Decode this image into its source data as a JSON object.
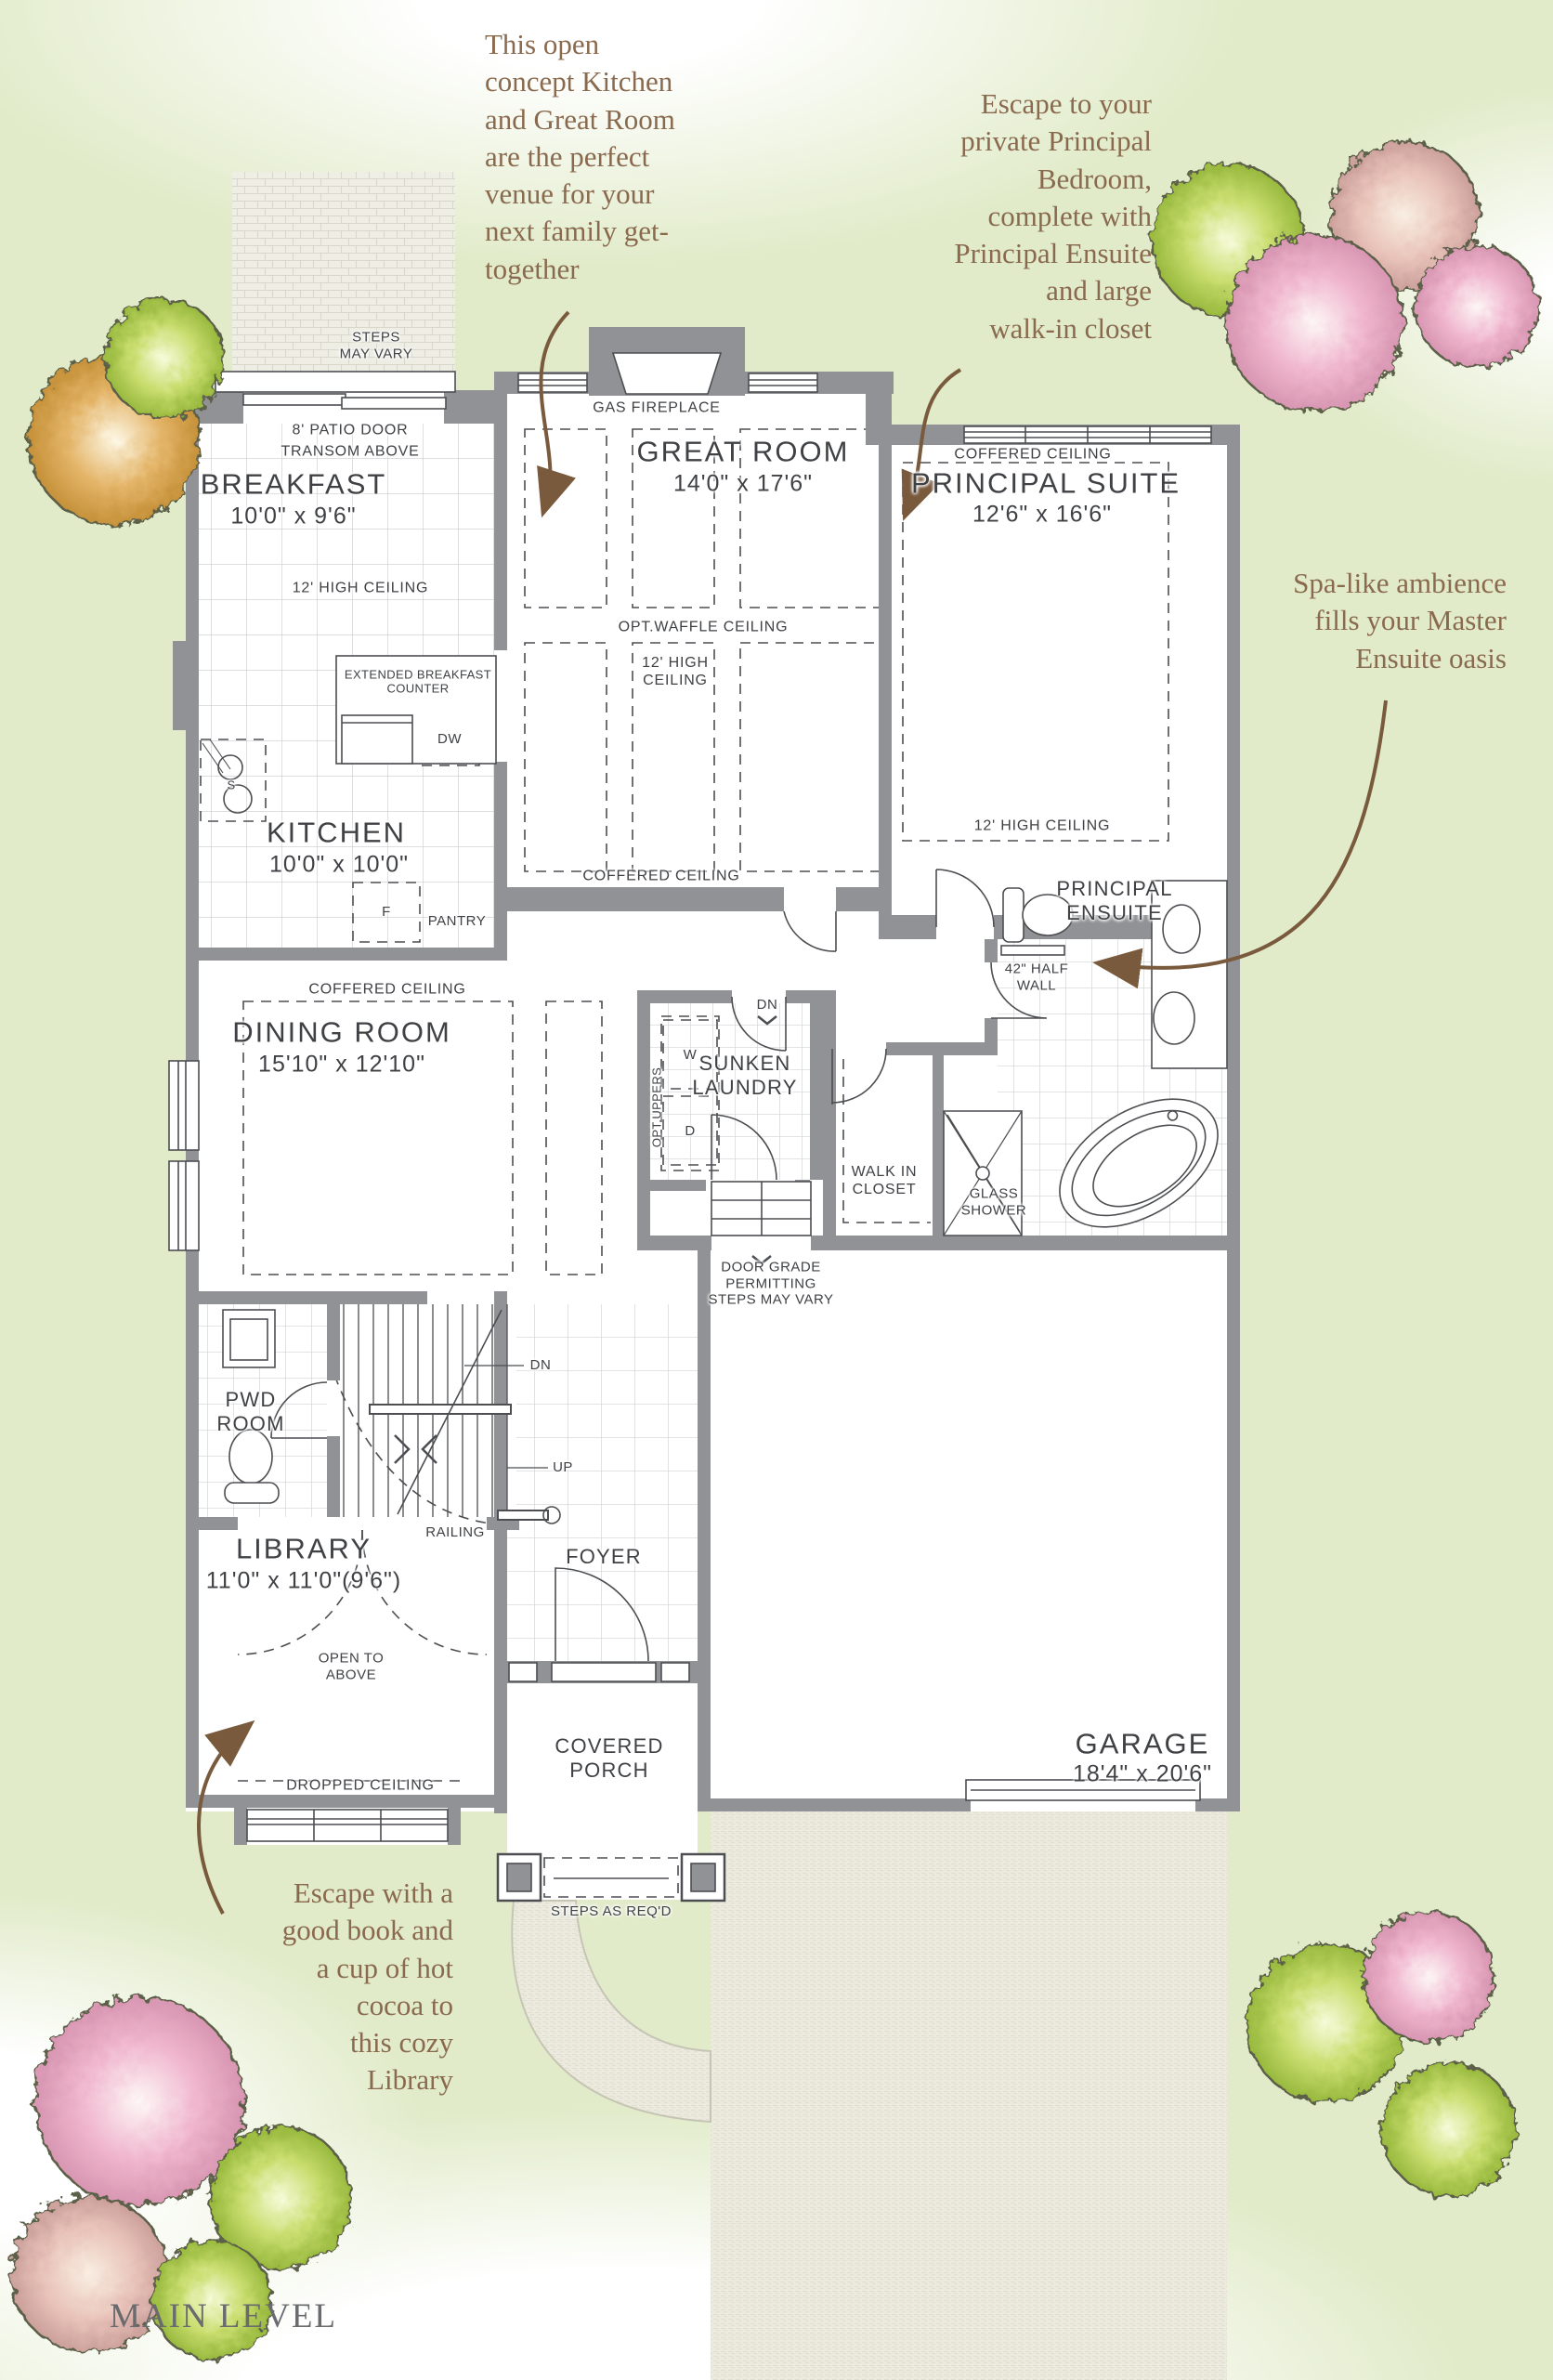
{
  "page": {
    "footer": "MAIN LEVEL"
  },
  "annotations": {
    "kitchen_note": "This open\nconcept Kitchen\nand Great Room\nare the perfect\nvenue for your\nnext family get-\ntogether",
    "principal_note": "Escape to your\nprivate Principal\nBedroom,\ncomplete with\nPrincipal Ensuite\nand large\nwalk-in closet",
    "ensuite_note": "Spa-like ambience\nfills your Master\nEnsuite oasis",
    "library_note": "Escape with a\ngood book and\na cup of hot\ncocoa to\nthis cozy\nLibrary"
  },
  "rooms": {
    "patio": {
      "steps": "STEPS\nMAY VARY",
      "door": "8' PATIO DOOR",
      "transom": "TRANSOM ABOVE"
    },
    "breakfast": {
      "name": "BREAKFAST",
      "dims": "10'0\" x 9'6\"",
      "ceiling": "12' HIGH CEILING"
    },
    "great_room": {
      "name": "GREAT ROOM",
      "dims": "14'0\" x 17'6\"",
      "fireplace": "GAS FIREPLACE",
      "waffle": "OPT.WAFFLE CEILING",
      "ceiling": "12' HIGH\nCEILING",
      "coffered": "COFFERED CEILING"
    },
    "principal_suite": {
      "name": "PRINCIPAL SUITE",
      "dims": "12'6\" x 16'6\"",
      "coffered": "COFFERED CEILING",
      "ceiling": "12' HIGH CEILING"
    },
    "kitchen": {
      "name": "KITCHEN",
      "dims": "10'0\" x 10'0\"",
      "counter": "EXTENDED BREAKFAST\nCOUNTER",
      "dishwasher": "DW",
      "sink": "S",
      "fridge": "F",
      "pantry": "PANTRY"
    },
    "dining": {
      "name": "DINING ROOM",
      "dims": "15'10\" x 12'10\"",
      "coffered": "COFFERED CEILING",
      "uppers": "OPT.UPPERS"
    },
    "laundry": {
      "name": "SUNKEN\nLAUNDRY",
      "washer": "W",
      "dryer": "D",
      "dn": "DN"
    },
    "walk_in_closet": {
      "name": "WALK IN\nCLOSET"
    },
    "ensuite": {
      "name": "PRINCIPAL\nENSUITE",
      "half_wall": "42\" HALF\nWALL",
      "shower": "GLASS\nSHOWER"
    },
    "pwd": {
      "name": "PWD\nROOM"
    },
    "stairs": {
      "dn": "DN",
      "up": "UP",
      "railing": "RAILING"
    },
    "library": {
      "name": "LIBRARY",
      "dims": "11'0\" x 11'0\"(9'6\")",
      "open_above": "OPEN TO\nABOVE",
      "dropped": "DROPPED CEILING"
    },
    "foyer": {
      "name": "FOYER"
    },
    "porch": {
      "name": "COVERED\nPORCH",
      "steps": "STEPS AS REQ'D"
    },
    "garage": {
      "name": "GARAGE",
      "dims": "18'4\" x 20'6\"",
      "door_grade": "DOOR GRADE\nPERMITTING\nSTEPS MAY VARY"
    }
  },
  "colors": {
    "wall": "#909295",
    "line": "#4c4e52",
    "label": "#3f4145",
    "annotation": "#8a6a4e",
    "background_green": "#e1ebc9",
    "footer_gray": "#6a6b6e",
    "arrow_brown": "#7a5a3d"
  }
}
